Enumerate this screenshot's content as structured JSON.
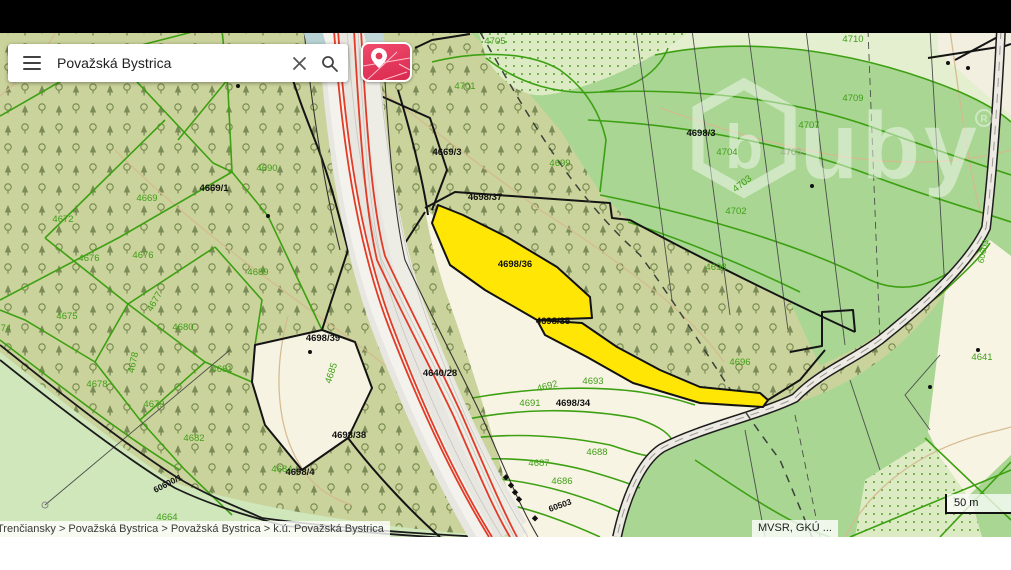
{
  "window": {
    "topbar_color": "#000000"
  },
  "search": {
    "value": "Považská Bystrica",
    "placeholder": "Považská Bystrica",
    "menu_icon": "hamburger-icon",
    "clear_icon": "close-icon",
    "search_icon": "magnifier-icon"
  },
  "map_type_button": {
    "label": "map-layers",
    "color": "#e23b5c"
  },
  "watermark": {
    "logo_letter": "b",
    "logo_rest": "uby",
    "registered": "®"
  },
  "breadcrumb": {
    "text": "Trenčiansky > Považská Bystrica > Považská Bystrica > k.ú. Považská Bystrica"
  },
  "attribution": {
    "text": "MVSR, GKÚ ..."
  },
  "scale_bar": {
    "text": "50 m"
  },
  "colors": {
    "forest_olive": "#cbd39c",
    "meadow_green": "#a9d693",
    "meadow_light": "#cfe7bb",
    "pale_field": "#e4efcf",
    "cream": "#f8f4e4",
    "scrub_bg": "#dcebc4",
    "parcel_line_green": "#3da012",
    "boundary_black": "#141414",
    "highlight_yellow": "#ffe604",
    "contour_tan": "#d4ba8e",
    "road_red": "#e23b28",
    "label_green": "#3f9e17",
    "label_black": "#111111"
  },
  "map": {
    "highlighted_parcels": [
      "4698/36",
      "4698/35"
    ],
    "labels": [
      {
        "t": "4705",
        "x": 495,
        "y": 44,
        "c": "g"
      },
      {
        "t": "4701",
        "x": 465,
        "y": 89,
        "c": "g"
      },
      {
        "t": "4699",
        "x": 560,
        "y": 166,
        "c": "g"
      },
      {
        "t": "4710",
        "x": 853,
        "y": 42,
        "c": "g"
      },
      {
        "t": "4709",
        "x": 853,
        "y": 101,
        "c": "g"
      },
      {
        "t": "4707",
        "x": 809,
        "y": 128,
        "c": "g"
      },
      {
        "t": "4704",
        "x": 727,
        "y": 155,
        "c": "g"
      },
      {
        "t": "4706",
        "x": 791,
        "y": 155,
        "c": "m"
      },
      {
        "t": "4703",
        "x": 744,
        "y": 186,
        "c": "g",
        "r": -38
      },
      {
        "t": "4702",
        "x": 736,
        "y": 214,
        "c": "g"
      },
      {
        "t": "4698",
        "x": 716,
        "y": 270,
        "c": "g"
      },
      {
        "t": "4696",
        "x": 740,
        "y": 365,
        "c": "g"
      },
      {
        "t": "4641",
        "x": 982,
        "y": 360,
        "c": "g"
      },
      {
        "t": "4690",
        "x": 267,
        "y": 171,
        "c": "g"
      },
      {
        "t": "4669",
        "x": 147,
        "y": 201,
        "c": "g"
      },
      {
        "t": "4672",
        "x": 63,
        "y": 222,
        "c": "g"
      },
      {
        "t": "4676",
        "x": 89,
        "y": 261,
        "c": "g"
      },
      {
        "t": "4676",
        "x": 143,
        "y": 258,
        "c": "g"
      },
      {
        "t": "4689",
        "x": 258,
        "y": 275,
        "c": "g"
      },
      {
        "t": "4675",
        "x": 67,
        "y": 319,
        "c": "g"
      },
      {
        "t": "4680",
        "x": 183,
        "y": 330,
        "c": "g"
      },
      {
        "t": "4677",
        "x": 157,
        "y": 303,
        "c": "g",
        "r": -60
      },
      {
        "t": "4681",
        "x": 222,
        "y": 372,
        "c": "g"
      },
      {
        "t": "4678",
        "x": 97,
        "y": 387,
        "c": "g"
      },
      {
        "t": "4678",
        "x": 136,
        "y": 363,
        "c": "g",
        "r": -78
      },
      {
        "t": "4679",
        "x": 154,
        "y": 407,
        "c": "g"
      },
      {
        "t": "4682",
        "x": 194,
        "y": 441,
        "c": "g"
      },
      {
        "t": "4685",
        "x": 334,
        "y": 374,
        "c": "g",
        "r": -72
      },
      {
        "t": "4684",
        "x": 282,
        "y": 472,
        "c": "g"
      },
      {
        "t": "4692",
        "x": 548,
        "y": 389,
        "c": "g",
        "r": -15
      },
      {
        "t": "4693",
        "x": 593,
        "y": 384,
        "c": "g"
      },
      {
        "t": "4691",
        "x": 530,
        "y": 406,
        "c": "g"
      },
      {
        "t": "4688",
        "x": 597,
        "y": 455,
        "c": "g"
      },
      {
        "t": "4687",
        "x": 539,
        "y": 466,
        "c": "g"
      },
      {
        "t": "4686",
        "x": 562,
        "y": 484,
        "c": "g"
      },
      {
        "t": "4664",
        "x": 167,
        "y": 520,
        "c": "g"
      },
      {
        "t": "4674",
        "x": -10,
        "y": 331,
        "c": "g",
        "a": "start"
      },
      {
        "t": "4669/1",
        "x": 214,
        "y": 191,
        "c": "k"
      },
      {
        "t": "4669/3",
        "x": 447,
        "y": 155,
        "c": "k"
      },
      {
        "t": "4698/37",
        "x": 485,
        "y": 200,
        "c": "k"
      },
      {
        "t": "4698/36",
        "x": 515,
        "y": 267,
        "c": "k"
      },
      {
        "t": "4698/35",
        "x": 553,
        "y": 324,
        "c": "k"
      },
      {
        "t": "4698/34",
        "x": 573,
        "y": 406,
        "c": "k"
      },
      {
        "t": "4640/28",
        "x": 440,
        "y": 376,
        "c": "k"
      },
      {
        "t": "4698/39",
        "x": 323,
        "y": 341,
        "c": "k"
      },
      {
        "t": "4698/38",
        "x": 349,
        "y": 438,
        "c": "k"
      },
      {
        "t": "4698/4",
        "x": 300,
        "y": 475,
        "c": "k"
      },
      {
        "t": "4698/3",
        "x": 701,
        "y": 136,
        "c": "k"
      },
      {
        "t": "60503",
        "x": 561,
        "y": 508,
        "c": "k",
        "r": -20,
        "s": 8.5
      },
      {
        "t": "60600/1",
        "x": 169,
        "y": 486,
        "c": "k",
        "r": -27,
        "s": 8.5
      },
      {
        "t": "60603",
        "x": 986,
        "y": 252,
        "c": "g",
        "r": -78,
        "s": 8.5
      }
    ],
    "label_colors": {
      "g": "#3f9e17",
      "k": "#111111",
      "m": "#9aa98a"
    }
  }
}
